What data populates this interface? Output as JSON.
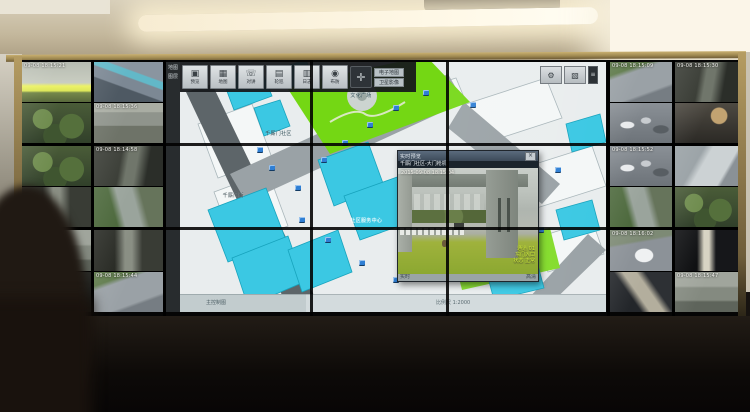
{
  "colors": {
    "accent_cyan": "#3bc8e3",
    "lawn_green": "#74d714",
    "road_grey": "#9aa2a6",
    "dark_road": "#5d6569",
    "marker_blue": "#2f7fd4",
    "frame_bronze": "#a98f58",
    "osd_green": "#cde838"
  },
  "left_panels": [
    {
      "tiles": [
        {
          "scene": "s-gateY",
          "osd": "09-08 18:15:21"
        },
        {
          "scene": "s-trees",
          "osd": ""
        }
      ]
    },
    {
      "tiles": [
        {
          "scene": "s-roofs",
          "osd": ""
        },
        {
          "scene": "s-bldg",
          "osd": "09-08 18:15:36"
        }
      ]
    },
    {
      "tiles": [
        {
          "scene": "s-trees",
          "osd": ""
        },
        {
          "scene": "s-alley",
          "osd": ""
        }
      ]
    },
    {
      "tiles": [
        {
          "scene": "s-alley2",
          "osd": "09-08 18:14:58"
        },
        {
          "scene": "s-lane",
          "osd": ""
        }
      ]
    },
    {
      "tiles": [
        {
          "scene": "s-court",
          "osd": "09-08 18:15:12"
        },
        {
          "scene": "s-garage",
          "osd": ""
        }
      ]
    },
    {
      "tiles": [
        {
          "scene": "s-alley",
          "osd": ""
        },
        {
          "scene": "s-street",
          "osd": "09-08 18:15:44"
        }
      ]
    }
  ],
  "right_panels": [
    {
      "tiles": [
        {
          "scene": "s-street",
          "osd": "09-08 18:15:09"
        },
        {
          "scene": "s-parking",
          "osd": ""
        }
      ]
    },
    {
      "tiles": [
        {
          "scene": "s-alley2",
          "osd": "09-08 18:15:30"
        },
        {
          "scene": "s-shop",
          "osd": ""
        }
      ]
    },
    {
      "tiles": [
        {
          "scene": "s-parking",
          "osd": "09-08 18:15:52"
        },
        {
          "scene": "s-lane",
          "osd": ""
        }
      ]
    },
    {
      "tiles": [
        {
          "scene": "s-ramp",
          "osd": ""
        },
        {
          "scene": "s-trees",
          "osd": ""
        }
      ]
    },
    {
      "tiles": [
        {
          "scene": "s-whitecar",
          "osd": "09-08 18:16:02"
        },
        {
          "scene": "s-stairs",
          "osd": ""
        }
      ]
    },
    {
      "tiles": [
        {
          "scene": "s-corridor",
          "osd": ""
        },
        {
          "scene": "s-court",
          "osd": "09-08 18:15:47"
        }
      ]
    }
  ],
  "map": {
    "edge_labels": [
      "地图",
      "图层"
    ],
    "toolbar": {
      "buttons": [
        {
          "icon": "monitor-icon",
          "label": "预览"
        },
        {
          "icon": "map-icon",
          "label": "地图"
        },
        {
          "icon": "intercom-icon",
          "label": "对讲"
        },
        {
          "icon": "tour-icon",
          "label": "轮巡"
        },
        {
          "icon": "log-icon",
          "label": "日志"
        },
        {
          "icon": "guard-icon",
          "label": "布防"
        }
      ],
      "dpad_glyph": "✛",
      "mini_buttons": [
        "电子地图",
        "卫星影像"
      ],
      "right_buttons": [
        {
          "icon": "gear-icon"
        },
        {
          "icon": "layers-icon"
        }
      ],
      "right_tab": "≡"
    },
    "labels": [
      {
        "text": "千厮门社区",
        "x": 20,
        "y": 27,
        "color": "#2b4a53"
      },
      {
        "text": "文化广场",
        "x": 40,
        "y": 12,
        "color": "#2b4a53"
      },
      {
        "text": "社区服务中心",
        "x": 40,
        "y": 62,
        "color": "#ffffff"
      },
      {
        "text": "千厮门街",
        "x": 10,
        "y": 52,
        "color": "#3a4a50"
      }
    ],
    "camera_markers": [
      {
        "x": 18,
        "y": 34
      },
      {
        "x": 21,
        "y": 41
      },
      {
        "x": 27,
        "y": 49
      },
      {
        "x": 33,
        "y": 38
      },
      {
        "x": 38,
        "y": 31
      },
      {
        "x": 44,
        "y": 24
      },
      {
        "x": 50,
        "y": 17
      },
      {
        "x": 57,
        "y": 11
      },
      {
        "x": 28,
        "y": 62
      },
      {
        "x": 34,
        "y": 70
      },
      {
        "x": 42,
        "y": 79
      },
      {
        "x": 50,
        "y": 86
      },
      {
        "x": 62,
        "y": 50
      },
      {
        "x": 84,
        "y": 66
      },
      {
        "x": 88,
        "y": 42
      },
      {
        "x": 68,
        "y": 16
      }
    ],
    "status": {
      "left": "主控制图",
      "right": "比例尺 1:2000"
    },
    "popup": {
      "title": "实时预览",
      "close_label": "×",
      "camera_name": "千厮门社区-大门枪机",
      "timestamp": "2015-09-08 18:15:04",
      "osd_lines": [
        "通道 01",
        "东门入口",
        "状态 正常"
      ],
      "footer_left": "实时",
      "footer_right": "高清"
    }
  }
}
